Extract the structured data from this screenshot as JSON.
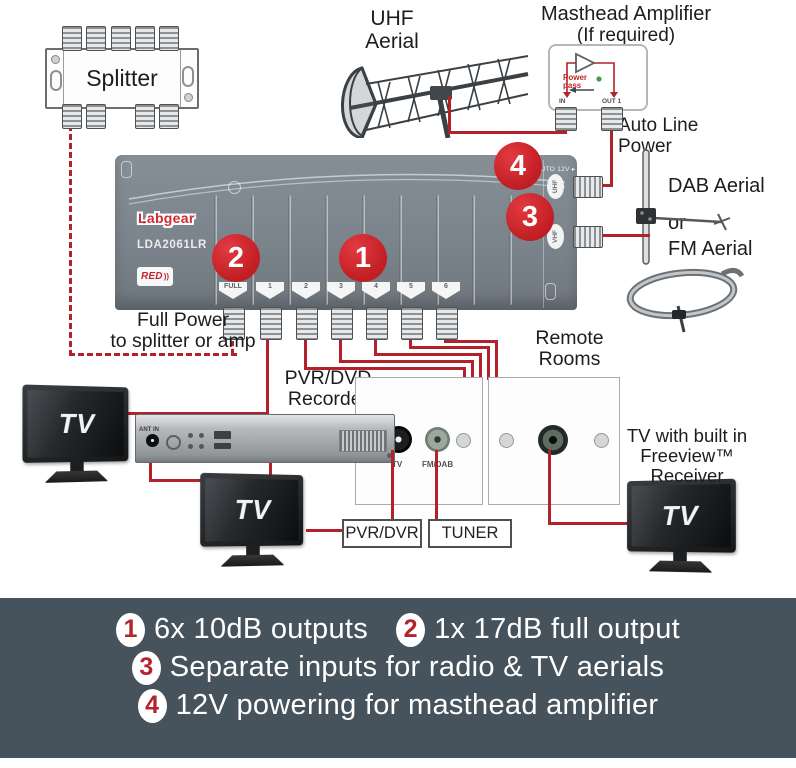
{
  "diagram": {
    "splitter": {
      "label": "Splitter"
    },
    "uhf_aerial": {
      "line1": "UHF",
      "line2": "Aerial"
    },
    "masthead": {
      "title": "Masthead Amplifier",
      "subtitle": "(If required)",
      "power_pass_1": "Power",
      "power_pass_2": "pass",
      "in_label": "IN",
      "out_label": "OUT 1"
    },
    "auto_line_power": {
      "line1": "Auto Line",
      "line2": "Power"
    },
    "radio_aerials": {
      "dab": "DAB Aerial",
      "or": "or",
      "fm": "FM Aerial"
    },
    "amplifier": {
      "brand": "Labgear",
      "model": "LDA2061LR",
      "red_badge": "RED",
      "red_badge_waves": "))",
      "auto_12v": "AUTO 12V ▸",
      "ports": [
        "FULL",
        "1",
        "2",
        "3",
        "4",
        "5",
        "6"
      ],
      "inputs": {
        "uhf": "UHF",
        "vhf": "VHF"
      },
      "callouts": [
        "1",
        "2",
        "3",
        "4"
      ]
    },
    "full_power": {
      "line1": "Full Power",
      "line2": "to splitter or amp"
    },
    "recorder": {
      "label_line1": "PVR/DVD",
      "label_line2": "Recorder",
      "ant_in": "ANT IN"
    },
    "tv_screen_text": "TV",
    "remote_rooms": {
      "line1": "Remote",
      "line2": "Rooms"
    },
    "wall_plate_left": {
      "tv": "TV",
      "fm_dab": "FM/DAB"
    },
    "boxes": {
      "pvr_dvr": "PVR/DVR",
      "tuner": "TUNER"
    },
    "freeview": {
      "line1": "TV with built in",
      "line2": "Freeview™",
      "line3": "Receiver"
    }
  },
  "banner": {
    "features": [
      {
        "num": "1",
        "text": "6x 10dB outputs"
      },
      {
        "num": "2",
        "text": "1x 17dB full output"
      },
      {
        "num": "3",
        "text": "Separate inputs for radio & TV aerials"
      },
      {
        "num": "4",
        "text": "12V powering for masthead amplifier"
      }
    ]
  },
  "colors": {
    "wire_red": "#b2222a",
    "callout_red": "#c9232a",
    "amplifier_gray": "#7b848c",
    "banner_bg": "#47535c",
    "banner_number_red": "#b5242c"
  }
}
